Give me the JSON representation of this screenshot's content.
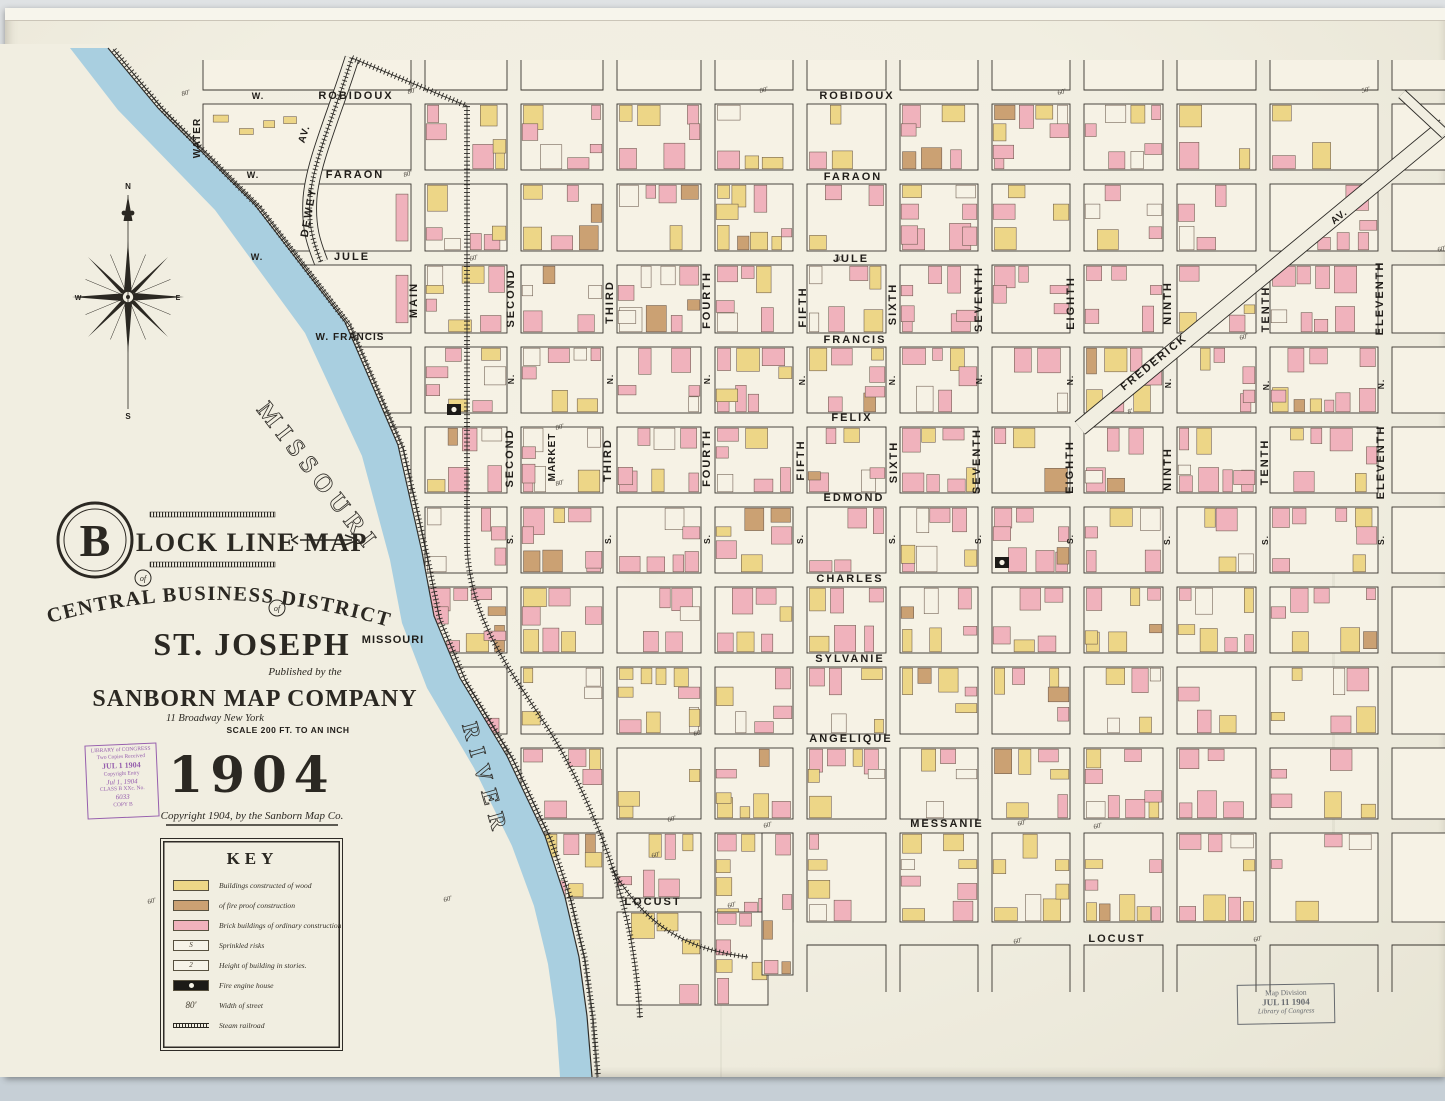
{
  "palette": {
    "paper": "#f1eee1",
    "block": "#f6f2e5",
    "ink": "#2b2924",
    "brick": "#f0b2bc",
    "wood": "#edd687",
    "fireproof": "#cba173",
    "river": "#a9cfe0",
    "stamp_purple": "#8d4fa8",
    "stamp_gray": "#50555d"
  },
  "title_block": {
    "big_letter": "B",
    "line1": "LOCK LINE MAP",
    "of1": "of",
    "line2": "CENTRAL BUSINESS DISTRICT",
    "of2": "of",
    "city": "ST. JOSEPH",
    "state": "MISSOURI",
    "published": "Published by the",
    "company": "SANBORN MAP COMPANY",
    "address": "11 Broadway New York",
    "scale": "SCALE 200 FT. TO AN INCH",
    "year": "1904",
    "copyright": "Copyright 1904, by the Sanborn Map Co."
  },
  "loc_stamp": {
    "lines": [
      "LIBRARY of CONGRESS",
      "Two Copies Received",
      "JUL 1 1904",
      "Copyright Entry",
      "Jul 1, 1904",
      "CLASS B  XXc. No.",
      "6033",
      "COPY B"
    ]
  },
  "map_division_stamp": {
    "line1": "Map  Division",
    "line2": "JUL  11 1904",
    "line3": "Library of Congress"
  },
  "key": {
    "title": "KEY",
    "entries": [
      {
        "type": "wood",
        "label": "Buildings constructed of wood"
      },
      {
        "type": "fireproof",
        "label": "of fire proof construction"
      },
      {
        "type": "brick",
        "label": "Brick buildings of ordinary construction"
      },
      {
        "type": "sprinkled",
        "glyph": "S",
        "label": "Sprinkled risks"
      },
      {
        "type": "stories",
        "glyph": "2",
        "label": "Height of building in stories."
      },
      {
        "type": "firehouse",
        "label": "Fire engine house"
      },
      {
        "type": "street_width",
        "glyph": "80'",
        "label": "Width of street"
      },
      {
        "type": "railroad",
        "label": "Steam railroad"
      }
    ]
  },
  "compass": {
    "n": "N",
    "s": "S",
    "e": "E",
    "w": "W",
    "cx": 128,
    "cy": 297
  },
  "river_labels": [
    {
      "text": "MISSOURI",
      "x": 256,
      "y": 410,
      "rot": 52,
      "size": 25,
      "spacing": 7
    },
    {
      "text": "RIVER",
      "x": 462,
      "y": 725,
      "rot": 74,
      "size": 23,
      "spacing": 9
    }
  ],
  "street_labels": [
    {
      "t": "W.",
      "x": 258,
      "y": 99,
      "s": 9
    },
    {
      "t": "ROBIDOUX",
      "x": 356,
      "y": 99,
      "s": 11
    },
    {
      "t": "ROBIDOUX",
      "x": 857,
      "y": 99,
      "s": 11
    },
    {
      "t": "W.",
      "x": 253,
      "y": 178,
      "s": 9
    },
    {
      "t": "FARAON",
      "x": 355,
      "y": 178,
      "s": 11
    },
    {
      "t": "FARAON",
      "x": 853,
      "y": 180,
      "s": 11
    },
    {
      "t": "W.",
      "x": 257,
      "y": 260,
      "s": 9
    },
    {
      "t": "JULE",
      "x": 352,
      "y": 260,
      "s": 11
    },
    {
      "t": "JULE",
      "x": 851,
      "y": 262,
      "s": 11
    },
    {
      "t": "W. FRANCIS",
      "x": 350,
      "y": 340,
      "s": 10
    },
    {
      "t": "FRANCIS",
      "x": 855,
      "y": 343,
      "s": 11
    },
    {
      "t": "FELIX",
      "x": 852,
      "y": 421,
      "s": 11
    },
    {
      "t": "EDMOND",
      "x": 854,
      "y": 501,
      "s": 11
    },
    {
      "t": "CHARLES",
      "x": 850,
      "y": 582,
      "s": 11
    },
    {
      "t": "SYLVANIE",
      "x": 850,
      "y": 662,
      "s": 11
    },
    {
      "t": "ANGELIQUE",
      "x": 851,
      "y": 742,
      "s": 11
    },
    {
      "t": "MESSANIE",
      "x": 947,
      "y": 827,
      "s": 11
    },
    {
      "t": "LOCUST",
      "x": 653,
      "y": 905,
      "s": 11
    },
    {
      "t": "LOCUST",
      "x": 1117,
      "y": 942,
      "s": 11
    },
    {
      "t": "WATER",
      "x": 200,
      "y": 138,
      "r": -90,
      "s": 10
    },
    {
      "t": "AV.",
      "x": 307,
      "y": 135,
      "r": -72,
      "s": 10
    },
    {
      "t": "DEWEY",
      "x": 312,
      "y": 213,
      "r": -80,
      "s": 11
    },
    {
      "t": "MAIN",
      "x": 417,
      "y": 300,
      "r": -90,
      "s": 11
    },
    {
      "t": "SECOND",
      "x": 514,
      "y": 298,
      "r": -90,
      "s": 11
    },
    {
      "t": "SECOND",
      "x": 513,
      "y": 458,
      "r": -90,
      "s": 11
    },
    {
      "t": "MARKET",
      "x": 555,
      "y": 457,
      "r": -90,
      "s": 10
    },
    {
      "t": "THIRD",
      "x": 613,
      "y": 302,
      "r": -90,
      "s": 11
    },
    {
      "t": "THIRD",
      "x": 611,
      "y": 460,
      "r": -90,
      "s": 11
    },
    {
      "t": "FOURTH",
      "x": 710,
      "y": 300,
      "r": -90,
      "s": 11
    },
    {
      "t": "FOURTH",
      "x": 710,
      "y": 458,
      "r": -90,
      "s": 11
    },
    {
      "t": "FIFTH",
      "x": 806,
      "y": 307,
      "r": -90,
      "s": 11
    },
    {
      "t": "FIFTH",
      "x": 804,
      "y": 460,
      "r": -90,
      "s": 11
    },
    {
      "t": "SIXTH",
      "x": 896,
      "y": 304,
      "r": -90,
      "s": 11
    },
    {
      "t": "SIXTH",
      "x": 897,
      "y": 462,
      "r": -90,
      "s": 11
    },
    {
      "t": "SEVENTH",
      "x": 982,
      "y": 299,
      "r": -90,
      "s": 11
    },
    {
      "t": "SEVENTH",
      "x": 980,
      "y": 461,
      "r": -90,
      "s": 11
    },
    {
      "t": "EIGHTH",
      "x": 1074,
      "y": 303,
      "r": -90,
      "s": 11
    },
    {
      "t": "EIGHTH",
      "x": 1073,
      "y": 467,
      "r": -90,
      "s": 11
    },
    {
      "t": "NINTH",
      "x": 1171,
      "y": 303,
      "r": -90,
      "s": 11
    },
    {
      "t": "NINTH",
      "x": 1171,
      "y": 469,
      "r": -90,
      "s": 11
    },
    {
      "t": "TENTH",
      "x": 1269,
      "y": 309,
      "r": -90,
      "s": 11
    },
    {
      "t": "TENTH",
      "x": 1268,
      "y": 462,
      "r": -90,
      "s": 11
    },
    {
      "t": "ELEVENTH",
      "x": 1383,
      "y": 298,
      "r": -90,
      "s": 11
    },
    {
      "t": "ELEVENTH",
      "x": 1384,
      "y": 462,
      "r": -90,
      "s": 11
    },
    {
      "t": "FREDERICK",
      "x": 1156,
      "y": 365,
      "r": -39,
      "s": 11
    },
    {
      "t": "AV.",
      "x": 1341,
      "y": 219,
      "r": -39,
      "s": 10
    },
    {
      "t": "N.",
      "x": 514,
      "y": 379,
      "r": -90,
      "s": 8.5
    },
    {
      "t": "N.",
      "x": 613,
      "y": 379,
      "r": -90,
      "s": 8.5
    },
    {
      "t": "N.",
      "x": 710,
      "y": 379,
      "r": -90,
      "s": 8.5
    },
    {
      "t": "N.",
      "x": 805,
      "y": 380,
      "r": -90,
      "s": 8.5
    },
    {
      "t": "N.",
      "x": 895,
      "y": 380,
      "r": -90,
      "s": 8.5
    },
    {
      "t": "N.",
      "x": 982,
      "y": 379,
      "r": -90,
      "s": 8.5
    },
    {
      "t": "N.",
      "x": 1073,
      "y": 380,
      "r": -90,
      "s": 8.5
    },
    {
      "t": "N.",
      "x": 1171,
      "y": 383,
      "r": -90,
      "s": 8.5
    },
    {
      "t": "N.",
      "x": 1269,
      "y": 385,
      "r": -90,
      "s": 8.5
    },
    {
      "t": "N.",
      "x": 1384,
      "y": 384,
      "r": -90,
      "s": 8.5
    },
    {
      "t": "S.",
      "x": 513,
      "y": 539,
      "r": -90,
      "s": 8.5
    },
    {
      "t": "S.",
      "x": 611,
      "y": 539,
      "r": -90,
      "s": 8.5
    },
    {
      "t": "S.",
      "x": 710,
      "y": 539,
      "r": -90,
      "s": 8.5
    },
    {
      "t": "S.",
      "x": 803,
      "y": 539,
      "r": -90,
      "s": 8.5
    },
    {
      "t": "S.",
      "x": 895,
      "y": 539,
      "r": -90,
      "s": 8.5
    },
    {
      "t": "S.",
      "x": 981,
      "y": 539,
      "r": -90,
      "s": 8.5
    },
    {
      "t": "S.",
      "x": 1073,
      "y": 539,
      "r": -90,
      "s": 8.5
    },
    {
      "t": "S.",
      "x": 1170,
      "y": 540,
      "r": -90,
      "s": 8.5
    },
    {
      "t": "S.",
      "x": 1268,
      "y": 540,
      "r": -90,
      "s": 8.5
    },
    {
      "t": "S.",
      "x": 1384,
      "y": 540,
      "r": -90,
      "s": 8.5
    }
  ],
  "width_marks": [
    {
      "t": "80'",
      "x": 182,
      "y": 96
    },
    {
      "t": "80'",
      "x": 408,
      "y": 94
    },
    {
      "t": "80'",
      "x": 760,
      "y": 93
    },
    {
      "t": "60'",
      "x": 1058,
      "y": 95
    },
    {
      "t": "50'",
      "x": 1362,
      "y": 93
    },
    {
      "t": "80'",
      "x": 404,
      "y": 177
    },
    {
      "t": "60'",
      "x": 470,
      "y": 261
    },
    {
      "t": "60'",
      "x": 836,
      "y": 262
    },
    {
      "t": "60'",
      "x": 1240,
      "y": 340
    },
    {
      "t": "80'",
      "x": 556,
      "y": 430
    },
    {
      "t": "80'",
      "x": 556,
      "y": 486
    },
    {
      "t": "60'",
      "x": 694,
      "y": 736
    },
    {
      "t": "60'",
      "x": 668,
      "y": 822
    },
    {
      "t": "60'",
      "x": 764,
      "y": 828
    },
    {
      "t": "60'",
      "x": 1018,
      "y": 826
    },
    {
      "t": "60'",
      "x": 1094,
      "y": 829
    },
    {
      "t": "60'",
      "x": 148,
      "y": 904
    },
    {
      "t": "60'",
      "x": 444,
      "y": 902
    },
    {
      "t": "60'",
      "x": 728,
      "y": 908
    },
    {
      "t": "60'",
      "x": 652,
      "y": 858
    },
    {
      "t": "60'",
      "x": 1014,
      "y": 944
    },
    {
      "t": "60'",
      "x": 1254,
      "y": 942
    },
    {
      "t": "8'",
      "x": 1128,
      "y": 414
    },
    {
      "t": "60'",
      "x": 1438,
      "y": 252
    }
  ],
  "map_geo": {
    "vlines": [
      196,
      418,
      514,
      610,
      708,
      800,
      893,
      985,
      1077,
      1170,
      1263,
      1385
    ],
    "hlines": [
      97,
      177,
      258,
      340,
      420,
      500,
      580,
      660,
      741,
      826
    ],
    "river_poly": "108,48 158,108 255,205 345,322 398,445 422,552 434,616 460,678 507,756 545,836 565,897 579,957 587,1016 592,1077 560,1077 556,1020 548,964 534,906 512,846 474,768 427,688 402,623 390,560 362,456 305,333 215,210 118,110 70,48",
    "mask_poly": "108,44 158,108 255,205 345,322 398,445 422,552 434,616 460,678 507,756 545,836 565,897 579,957 587,1016 592,1077 0,1077 0,44",
    "bank_line": "M108,48 L158,108 L255,205 L345,322 L398,445 L422,552 L434,616 L460,678 L507,756 L545,836 L565,897 L579,957 L587,1016 L592,1077",
    "rail_river": "M114,50 L163,110 L260,208 L350,326 L403,449 L427,556 L440,620 L466,682 L513,760 L551,840 L571,900 L585,959 L593,1017 L598,1077",
    "rail_main": "M352,58 L467,106 L467,540 C467,612 505,663 543,721 C573,765 602,832 616,879 C629,919 637,966 640,1018",
    "rail_branch": "M612,868 C645,928 690,950 748,957",
    "dewey_path": "M352,58 C333,118 313,162 310,198 C308,228 314,244 321,262",
    "frederick_path": "M1080,428 L1445,126",
    "frederick_spur": "M1402,94 L1445,134",
    "firehouses": [
      [
        447,
        404
      ],
      [
        995,
        557
      ]
    ]
  }
}
